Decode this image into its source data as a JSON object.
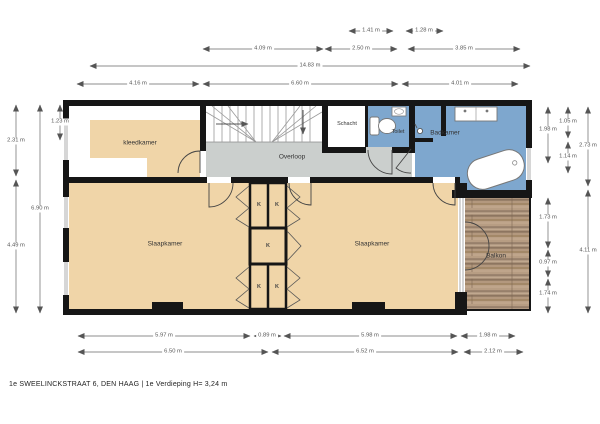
{
  "footer": {
    "text": "1e SWEELINCKSTRAAT 6, DEN HAAG | 1e Verdieping H= 3,24 m"
  },
  "rooms": {
    "kleedkamer": "kleedkamer",
    "overloop": "Overloop",
    "schacht": "Schacht",
    "toilet": "Toilet",
    "badkamer": "Badkamer",
    "slaapkamer_left": "Slaapkamer",
    "slaapkamer_right": "Slaapkamer",
    "balkon": "Balkon",
    "closet": "K"
  },
  "dims": {
    "top": [
      "1.41 m",
      "1.28 m",
      "4.09 m",
      "2.50 m",
      "3.85 m",
      "14.83 m",
      "4.16 m",
      "6.60 m",
      "4.01 m"
    ],
    "left": [
      "2.31 m",
      "4.49 m",
      "6.90 m",
      "1.23 m"
    ],
    "right": [
      "1.98 m",
      "1.05 m",
      "1.14 m",
      "2.73 m",
      "1.73 m",
      "0.97 m",
      "1.74 m",
      "4.11 m"
    ],
    "bottom": [
      "5.97 m",
      "0.89 m",
      "5.98 m",
      "1.98 m",
      "6.50 m",
      "6.52 m",
      "2.12 m"
    ]
  },
  "colors": {
    "wall": "#161616",
    "floor_tan": "#f0d5a8",
    "floor_gray": "#cbcfcd",
    "floor_blue": "#7ea7ce",
    "wood": "#a98f74"
  }
}
